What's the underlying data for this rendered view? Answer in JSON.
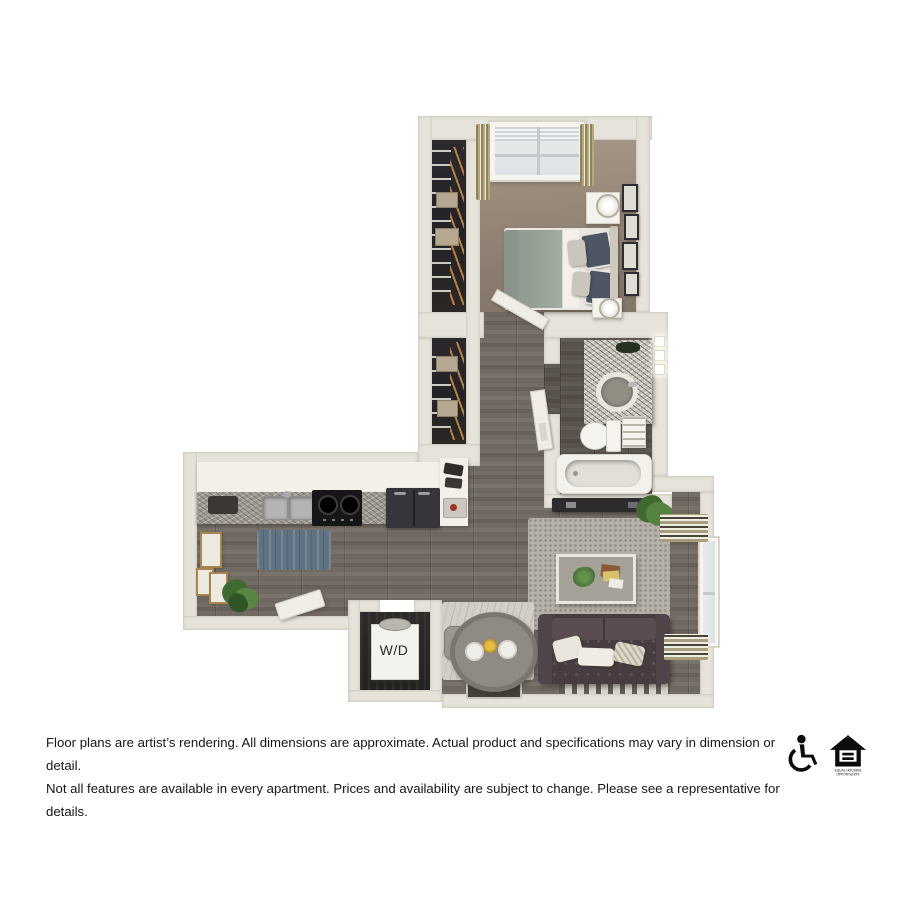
{
  "floorplan": {
    "washer_dryer_label": "W/D",
    "rooms": [
      "bedroom",
      "bedroom-closet",
      "hallway",
      "hallway-closet",
      "bathroom",
      "kitchen",
      "dining-area",
      "living-room",
      "washer-dryer-closet"
    ],
    "furnishings": [
      "bed",
      "nightstands",
      "lamps",
      "wall-art",
      "window",
      "wire-shelving",
      "vanity-sink",
      "toilet",
      "bathtub",
      "kitchen-sink",
      "stove",
      "refrigerator",
      "washer-dryer",
      "dining-table",
      "dining-chairs",
      "sofa",
      "coffee-table",
      "rugs",
      "plants",
      "tv-console",
      "doormat"
    ]
  },
  "disclaimer": {
    "line1": "Floor plans are artist’s rendering. All dimensions are approximate. Actual product and specifications may vary in dimension or detail.",
    "line2": "Not all features are available in every apartment. Prices and availability are subject to change. Please see a representative for details."
  },
  "icons": {
    "accessibility": "wheelchair-accessible-icon",
    "equal_housing": "equal-housing-opportunity-icon",
    "equal_housing_caption_line1": "EQUAL HOUSING",
    "equal_housing_caption_line2": "OPPORTUNITY"
  },
  "palette": {
    "background": "#ffffff",
    "wall": "#e6e3da",
    "wood_floor": "#6f6861",
    "bath_floor": "#57514b",
    "carpet": "#93postfix",
    "carpet_main": "#93857a",
    "closet_interior": "#232226",
    "hanger_wood": "#b9813f",
    "blue_rug": "#5f7384",
    "living_rug": "#b6b1a8",
    "dining_rug": "#d3cfc8",
    "sofa": "#483c40",
    "duvet": "#9aa59a",
    "accent_text": "#161616"
  }
}
